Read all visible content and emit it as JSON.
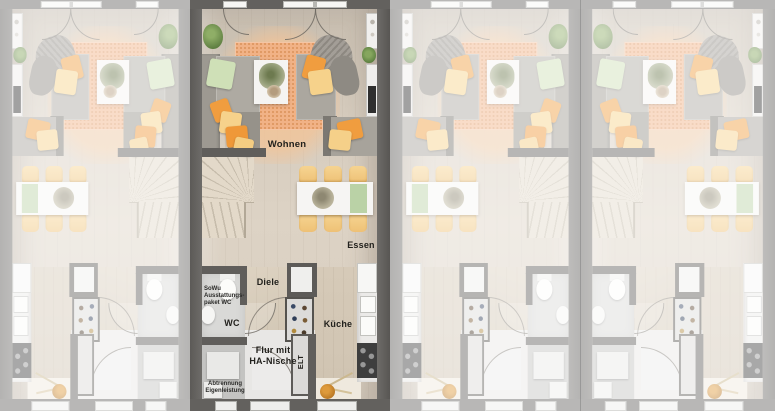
{
  "scene": {
    "description": "Top-down rendered floor plan of four identical row houses; second unit highlighted in color with room labels, others faded, alternating mirrored layout",
    "background_color": "#7c7c7c"
  },
  "units": [
    {
      "name": "unit-1",
      "mirrored": true,
      "faded": true,
      "show_labels": false,
      "width": 190
    },
    {
      "name": "unit-2",
      "mirrored": false,
      "faded": false,
      "show_labels": true,
      "width": 200
    },
    {
      "name": "unit-3",
      "mirrored": true,
      "faded": true,
      "show_labels": false,
      "width": 190
    },
    {
      "name": "unit-4",
      "mirrored": false,
      "faded": true,
      "show_labels": false,
      "width": 195
    }
  ],
  "labels": {
    "living": "Wohnen",
    "dining": "Essen",
    "hallway": "Diele",
    "wc": "WC",
    "kitchen": "Küche",
    "corridor_line1": "Flur mit",
    "corridor_line2": "HA-Nische",
    "elt": "ELT",
    "note_wc_line1": "SoWu",
    "note_wc_line2": "Ausstattungs-",
    "note_wc_line3": "paket WC",
    "note_partition_line1": "Abtrennung",
    "note_partition_line2": "Eigenleistung"
  },
  "colors": {
    "wall": "#63615e",
    "floor_wood": "#d6ccbe",
    "rug_orange": "#f1b286",
    "accent_orange": "#f09d3f",
    "accent_yellow": "#f6d28b",
    "accent_green": "#cfe0b7",
    "chair_yellow": "#f4cf85",
    "bench_green": "#bad2a6",
    "fade_overlay": "rgba(255,255,255,0.55)"
  }
}
